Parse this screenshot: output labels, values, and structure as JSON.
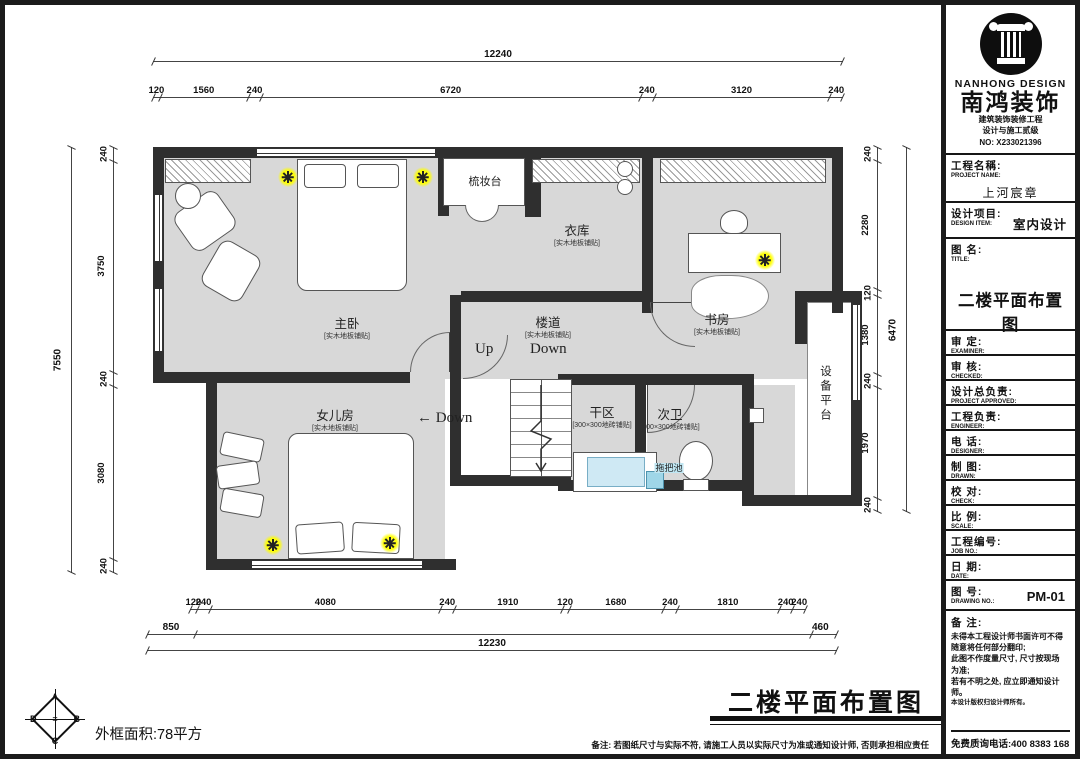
{
  "colors": {
    "wall": "#2f2f2f",
    "floor": "#d8d8d8",
    "light": "#ffff00",
    "mop_sink": "#9fd6e8",
    "basin": "#cfe9f4"
  },
  "dims": {
    "top": {
      "overall": "12240",
      "chain": [
        120,
        1560,
        240,
        6720,
        240,
        3120,
        240
      ]
    },
    "left": {
      "overall": "7550",
      "chain": [
        240,
        3750,
        240,
        3080,
        240
      ]
    },
    "right": {
      "overall": "6470",
      "chain": [
        240,
        2280,
        120,
        1380,
        240,
        1970,
        240
      ]
    },
    "bottom": {
      "overall": "12230",
      "chain": [
        120,
        240,
        4080,
        240,
        1910,
        120,
        1680,
        240,
        1810,
        240,
        240
      ],
      "left_seg": "850",
      "right_seg": "460"
    }
  },
  "rooms": {
    "zhuwo": {
      "name": "主卧",
      "note": "[实木地板铺贴]"
    },
    "shuzhuangtai": {
      "name": "梳妆台"
    },
    "yiku": {
      "name": "衣库",
      "note": "[实木地板铺贴]"
    },
    "shufang": {
      "name": "书房",
      "note": "[实木地板铺贴]"
    },
    "loudao": {
      "name": "楼道",
      "note": "[实木地板铺贴]"
    },
    "nverfang": {
      "name": "女儿房",
      "note": "[实木地板铺贴]"
    },
    "ganqu": {
      "name": "干区",
      "note": "[300×300地砖铺贴]"
    },
    "ciwei": {
      "name": "次卫",
      "note": "[300×300地砖铺贴]"
    },
    "tuobachi": {
      "name": "拖把池"
    },
    "shebeipingtai": {
      "name": "设备平台"
    }
  },
  "stair": {
    "up": "Up",
    "down": "Down",
    "down_left": "Down"
  },
  "lights": [
    {
      "x": 283,
      "y": 172
    },
    {
      "x": 418,
      "y": 172
    },
    {
      "x": 760,
      "y": 255
    },
    {
      "x": 268,
      "y": 540
    },
    {
      "x": 385,
      "y": 538
    }
  ],
  "plan_footer": {
    "title": "二楼平面布置图",
    "note": "备注: 若图纸尺寸与实际不符, 请施工人员以实际尺寸为准或通知设计师, 否则承担相应责任",
    "area": "外框面积:78平方"
  },
  "compass": {
    "top": "A",
    "left": "D",
    "right": "B",
    "bottom": "C"
  },
  "titleblock": {
    "logo": {
      "brand_en": "NANHONG DESIGN",
      "brand_cn": "南鸿装饰",
      "cert1": "建筑装饰装修工程",
      "cert2": "设计与施工贰级",
      "no": "NO: X233021396"
    },
    "fields": [
      {
        "cn": "工程名稱:",
        "en": "PROJECT NAME:",
        "value": "上河宸章",
        "type": "wide"
      },
      {
        "cn": "设计项目:",
        "en": "DESIGN ITEM:",
        "value": "室内设计",
        "type": "item"
      },
      {
        "cn": "图  名:",
        "en": "TITLE:",
        "value": "二楼平面布置图",
        "type": "big"
      },
      {
        "cn": "审  定:",
        "en": "EXAMINER:",
        "value": "",
        "type": "std"
      },
      {
        "cn": "审  核:",
        "en": "CHECKED:",
        "value": "",
        "type": "std"
      },
      {
        "cn": "设计总负责:",
        "en": "PROJECT APPROVED:",
        "value": "",
        "type": "std"
      },
      {
        "cn": "工程负责:",
        "en": "ENGINEER:",
        "value": "",
        "type": "std"
      },
      {
        "cn": "电  话:",
        "en": "DESIGNER:",
        "value": "",
        "type": "std"
      },
      {
        "cn": "制  图:",
        "en": "DRAWN:",
        "value": "",
        "type": "std"
      },
      {
        "cn": "校  对:",
        "en": "CHECK:",
        "value": "",
        "type": "std"
      },
      {
        "cn": "比  例:",
        "en": "SCALE:",
        "value": "",
        "type": "std"
      },
      {
        "cn": "工程编号:",
        "en": "JOB NO.:",
        "value": "",
        "type": "std"
      },
      {
        "cn": "日  期:",
        "en": "DATE:",
        "value": "",
        "type": "std"
      },
      {
        "cn": "图  号:",
        "en": "DRAWING NO.:",
        "value": "PM-01",
        "type": "num"
      }
    ],
    "remark": {
      "label": "备 注:",
      "lines": [
        "未得本工程设计师书面许可不得",
        "随意将任何部分翻印;",
        "此图不作度量尺寸, 尺寸按现场",
        "为准;",
        "若有不明之处, 应立即通知设计",
        "师。",
        "本设计版权归设计师所有。"
      ],
      "phone": "免费质询电话:400 8383 168"
    }
  }
}
